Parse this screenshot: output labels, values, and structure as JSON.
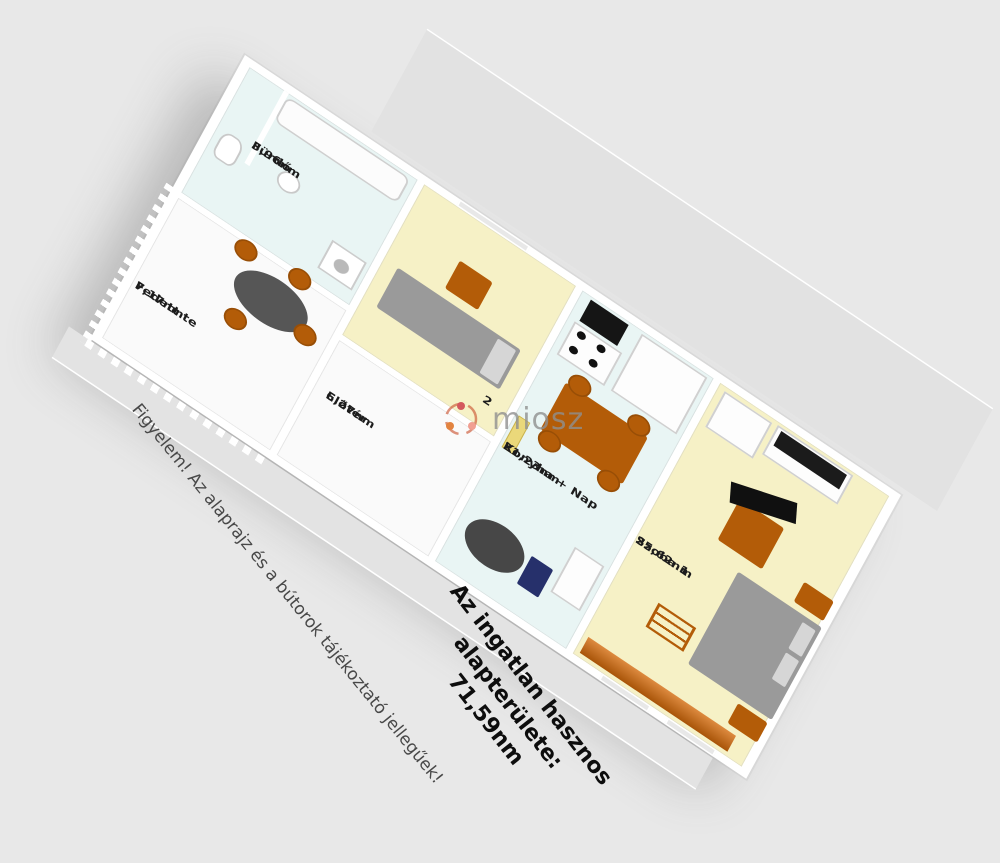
{
  "watermark": {
    "text": "miosz"
  },
  "disclaimer": "Figyelem! Az alaprajz és a bútorok tájékoztató jellegűek!",
  "area_summary": "Az ingatlan hasznos alapterülete: 71,59nm",
  "rooms": [
    {
      "name": "Szoba 1",
      "area": "25,62nm"
    },
    {
      "name": "Konyha + Nap",
      "area": "21,23nm"
    },
    {
      "name": "Előtér",
      "area": "6,27nm"
    },
    {
      "name": "Fürdő",
      "area": "3,96nm"
    },
    {
      "name": "Fedett te",
      "area": "7,17nm"
    },
    {
      "name": "2",
      "area": ""
    }
  ],
  "colors": {
    "background": "#e8e8e8",
    "wall_white": "#ffffff",
    "floor_yellow": "#f6f1c6",
    "floor_blue": "#e9f5f4",
    "floor_white": "#fafafa",
    "furniture_orange": "#b35c08",
    "stripe_orange": "#c9681a",
    "bed_gray": "#9a9a9a",
    "dark": "#151515",
    "watermark_gray": "#909090"
  }
}
